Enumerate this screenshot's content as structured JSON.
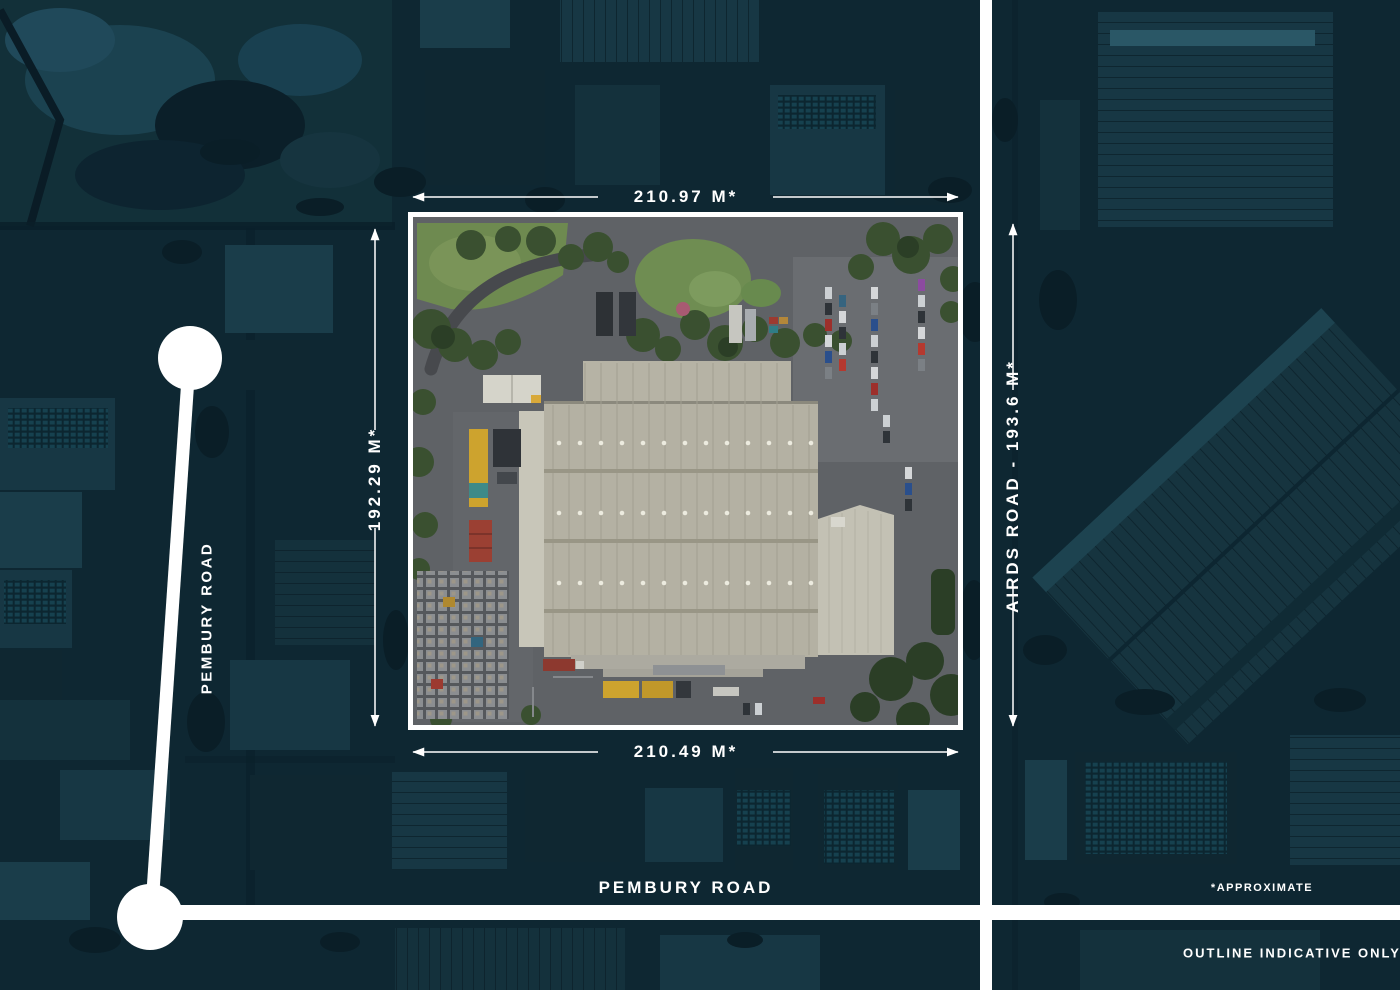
{
  "property_map": {
    "dimensions": {
      "top": "210.97 M*",
      "bottom": "210.49 M*",
      "left": "192.29 M*",
      "right": "AIRDS ROAD - 193.6 M*"
    },
    "road_labels": {
      "pembury_west": "PEMBURY ROAD",
      "pembury_south": "PEMBURY ROAD"
    },
    "disclaimers": {
      "approximate": "*APPROXIMATE",
      "outline_indicative": "OUTLINE INDICATIVE ONLY"
    },
    "colors": {
      "background_base": "#0d2631",
      "overlay_white": "#ffffff",
      "parcel_roof": "#b4b1a3",
      "parcel_asphalt": "#5f6266",
      "parcel_grass": "#6f8d52",
      "parcel_tree": "#3a5030",
      "container_yellow": "#cda32e",
      "container_red": "#9b4033"
    }
  }
}
